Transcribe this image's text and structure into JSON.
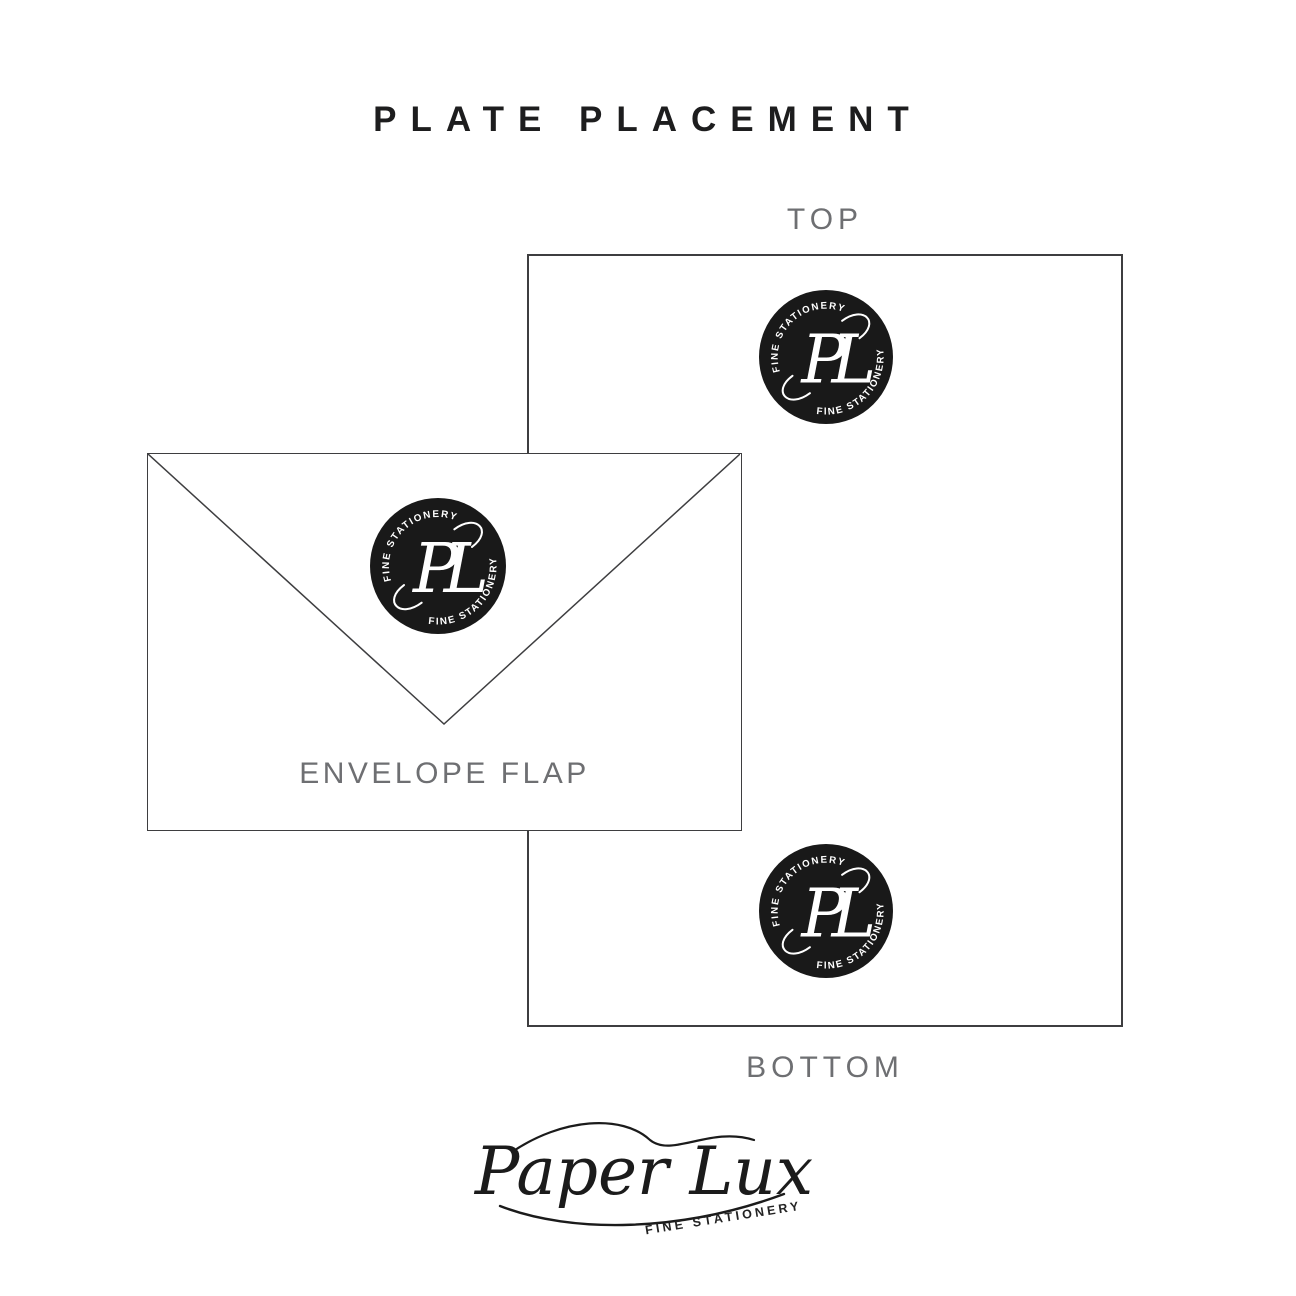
{
  "title": "PLATE PLACEMENT",
  "labels": {
    "top": "TOP",
    "bottom": "BOTTOM",
    "envelope_flap": "ENVELOPE FLAP"
  },
  "seal": {
    "arc_text": "FINE STATIONERY",
    "monogram": "PL",
    "background_color": "#191919",
    "text_color": "#ffffff"
  },
  "footer_logo": {
    "script_text": "Paper Lux",
    "subtext": "FINE STATIONERY"
  },
  "colors": {
    "label_gray": "#6e6f72",
    "title_black": "#1d1d1e",
    "outline": "#3e3e40"
  }
}
